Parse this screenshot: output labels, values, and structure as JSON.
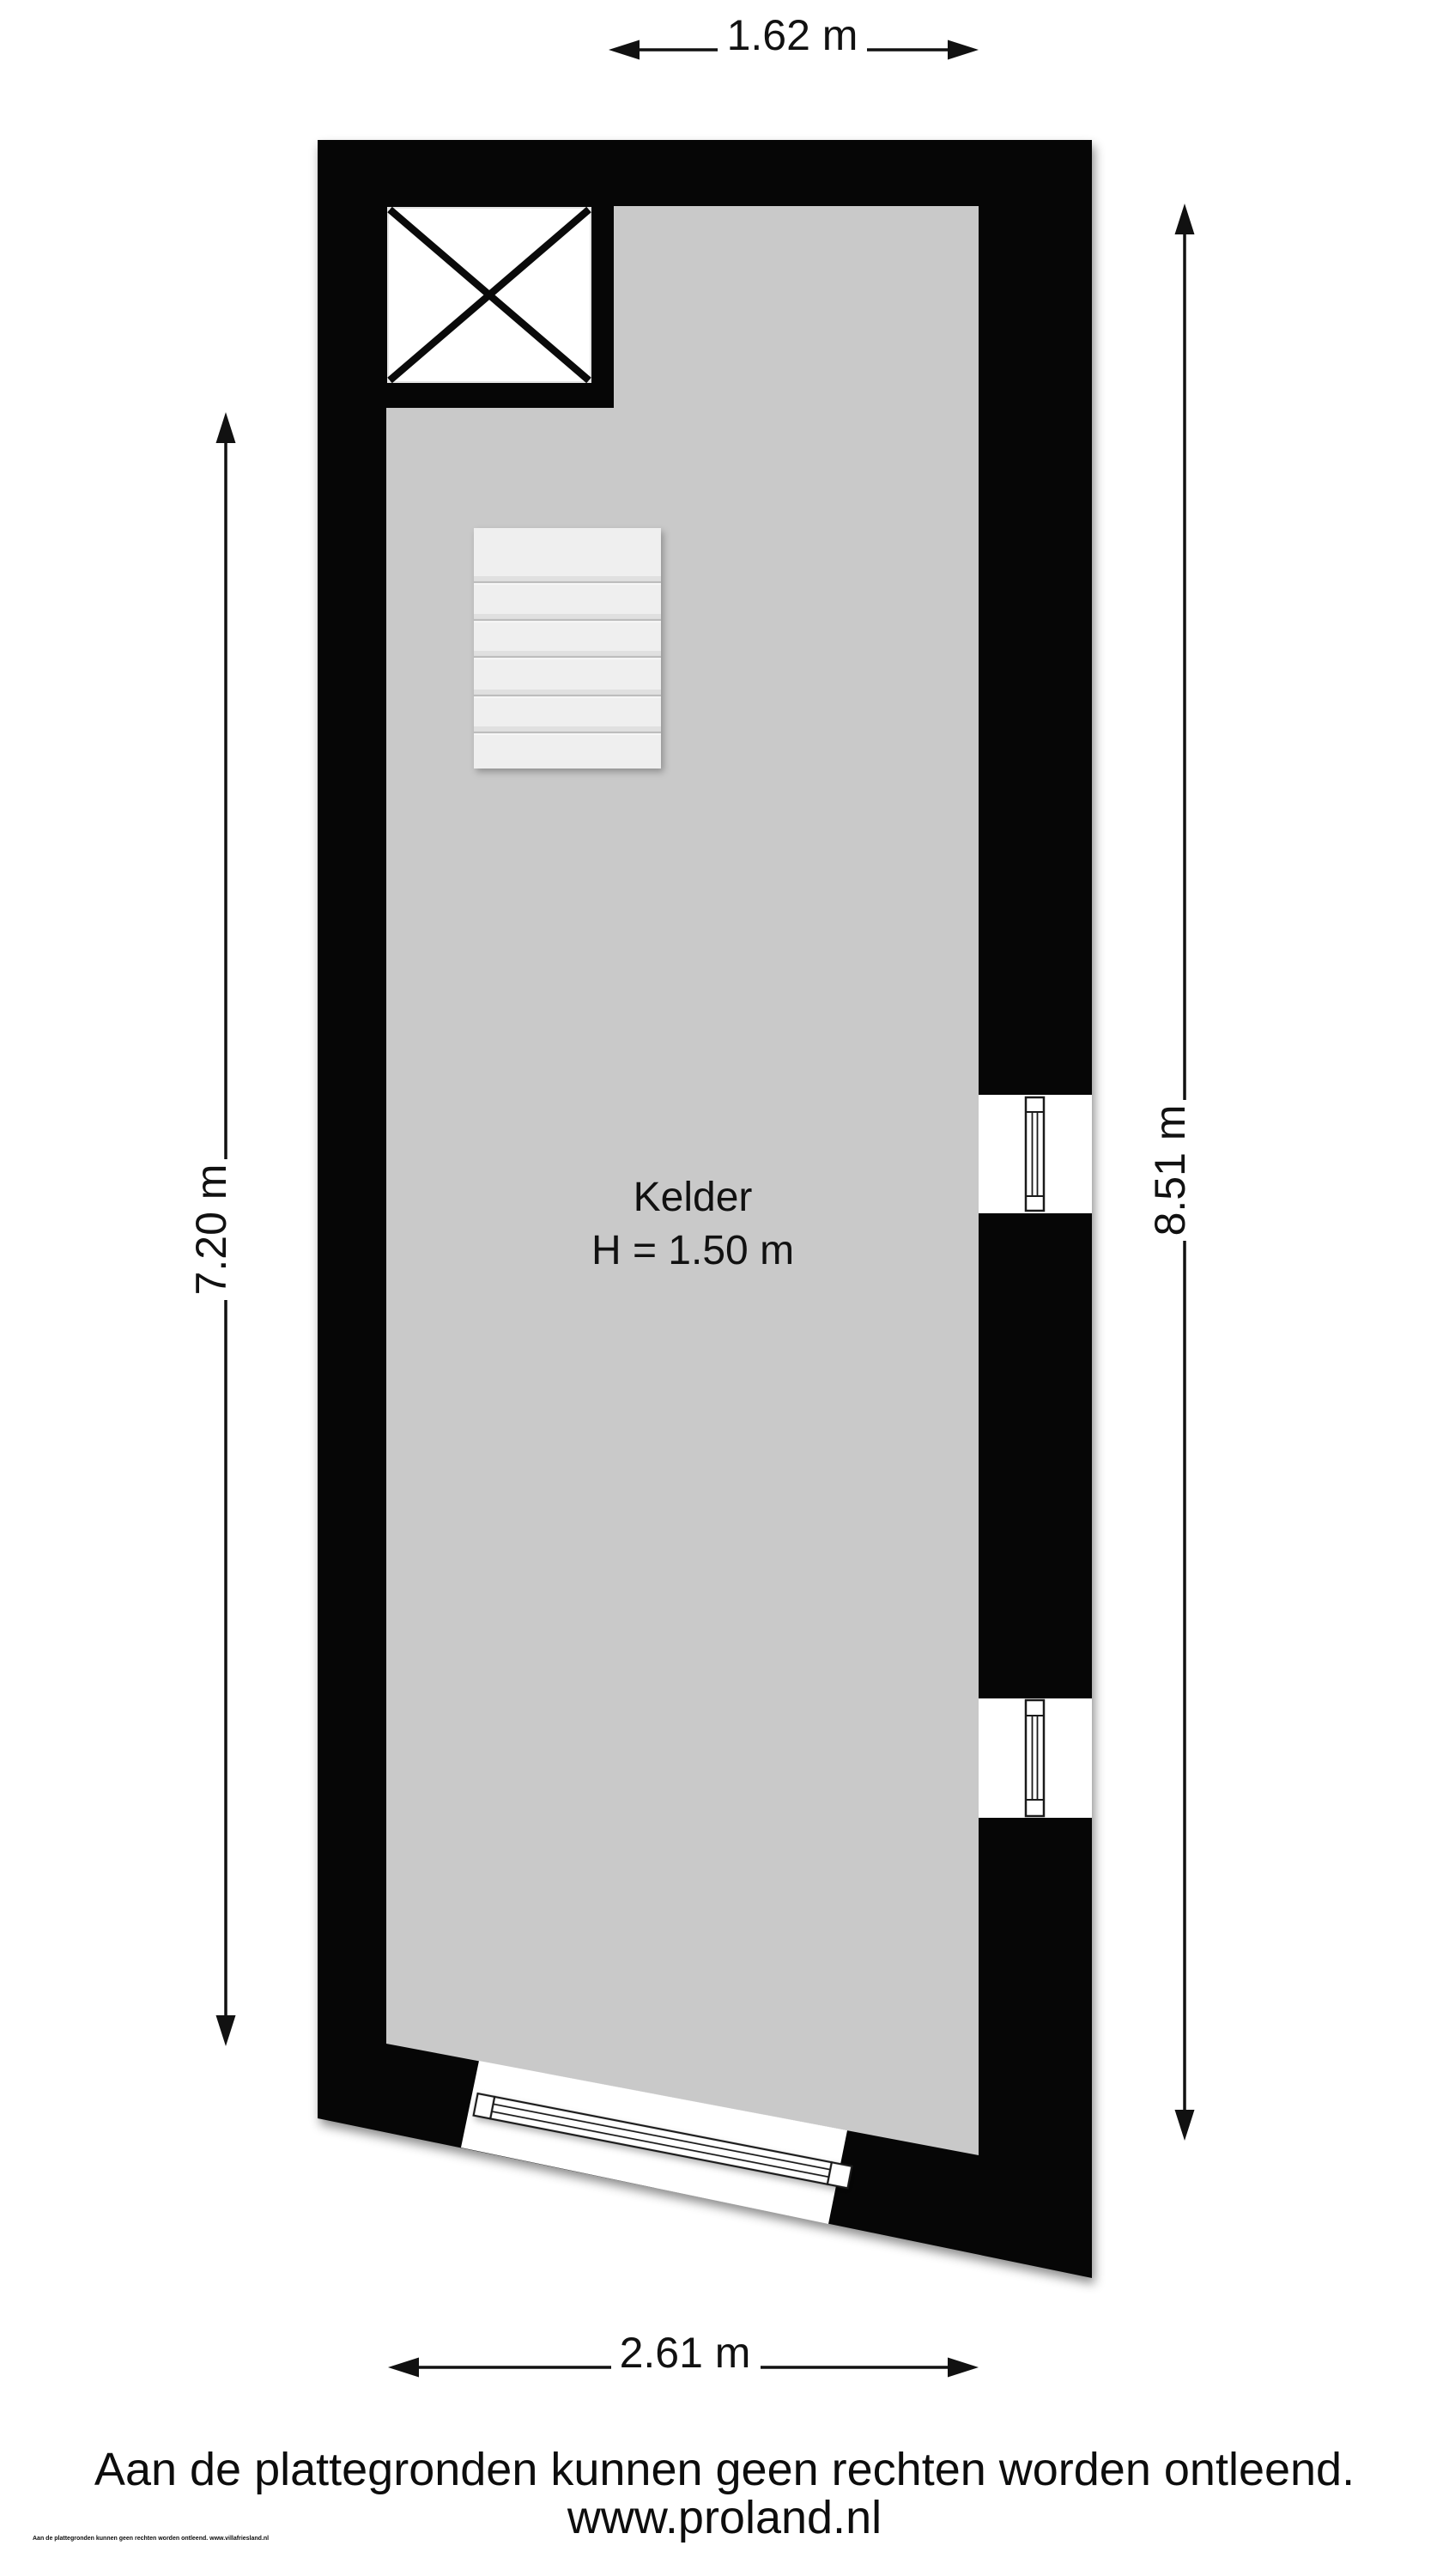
{
  "plan": {
    "room": {
      "name": "Kelder",
      "height_note": "H = 1.50 m"
    },
    "dimensions": {
      "top": "1.62 m",
      "left": "7.20 m",
      "right": "8.51 m",
      "bottom": "2.61 m"
    }
  },
  "footer": {
    "disclaimer": "Aan de plattegronden kunnen geen rechten worden ontleend.",
    "website": "www.proland.nl",
    "fine_print": "Aan de plattegronden kunnen geen rechten worden ontleend. www.villafriesland.nl"
  },
  "colors": {
    "wall": "#060606",
    "floor": "#c9c9c9",
    "stair_tread": "#efefef",
    "line": "#111111",
    "background": "#ffffff"
  }
}
